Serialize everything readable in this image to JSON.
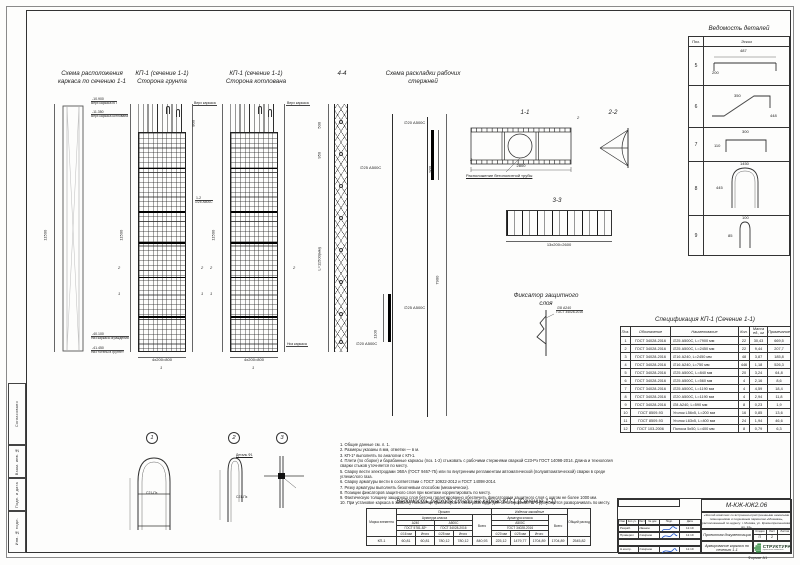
{
  "sheet": {
    "format_label": "Формат А1"
  },
  "side_strip": {
    "agreed": "Согласовано",
    "vzam": "Взам. инв. №",
    "podp": "Подп. и дата",
    "inv": "Инв. № подл."
  },
  "titles": {
    "scheme_location_l1": "Схема расположения",
    "scheme_location_l2": "каркаса по сечению 1-1",
    "kp1_ground_l1": "КП-1 (сечение 1-1)",
    "kp1_ground_l2": "Сторона грунта",
    "kp1_pit_l1": "КП-1 (сечение 1-1)",
    "kp1_pit_l2": "Сторона котлована",
    "section44": "4-4",
    "bars_l1": "Схема раскладки рабочих",
    "bars_l2": "стержней",
    "section11": "1-1",
    "section22": "2-2",
    "section33": "3-3",
    "fixator_l1": "Фиксатор защитного",
    "fixator_l2": "слоя"
  },
  "callouts": {
    "top1_val": "-10.900",
    "top1_text": "Верх каркаса КП",
    "top2_val": "-11.350",
    "top2_text": "Верх каркаса котлована",
    "bot1_val": "-40.100",
    "bot1_text": "Низ каркаса ограждения",
    "bot2_val": "-41.450",
    "bot2_text": "Низ «стены в грунте»",
    "cage_top": "Верх каркаса",
    "cage_bottom": "Низ каркаса",
    "pipe_note": "Расположение бетонолитной трубы"
  },
  "dims": {
    "cage_height": "11500",
    "cage_top": "800",
    "cage_bottom": "4х200=800",
    "lattice_1": "500",
    "lattice_2": "950",
    "lattice_len": "L=11500(мм)",
    "bars_long": "7900",
    "bars_top": "900",
    "bars_bottom": "1100",
    "bar_label_1": "∅25 А500С",
    "bar_label_2": "∅20 А500С",
    "bar_label_3": "∅25 А500С",
    "bar_label_4": "∅20 А500С",
    "cage_bars_mark": "1-2",
    "cage_bars_label": "∅25 А500С",
    "sec11_width": "2800",
    "sec33_width": "13х200=2600",
    "fix_label_1": "∅8 А240",
    "fix_label_2": "ГОСТ 34028-2016",
    "mark1": "1",
    "mark2": "2",
    "mark3": "3",
    "mark4": "4"
  },
  "details_bottom": {
    "d1": "1",
    "d2": "2",
    "d3": "3",
    "weld_mark": "С21-Пз",
    "d2_note": "Деталь Ф1"
  },
  "details_table": {
    "title": "Ведомость деталей",
    "col_poz": "Поз.",
    "col_sketch": "Эскиз",
    "rows": [
      {
        "poz": "5",
        "dim_a": "487",
        "dim_b": "200"
      },
      {
        "poz": "6",
        "dim_a": "350",
        "dim_b": "448"
      },
      {
        "poz": "7",
        "dim_a": "300",
        "dim_b": "110"
      },
      {
        "poz": "8",
        "dim_a": "1450",
        "dim_b": "445"
      },
      {
        "poz": "9",
        "dim_a": "100",
        "dim_b": "85"
      }
    ]
  },
  "spec_table": {
    "title": "Спецификация КП-1 (Сечение 1-1)",
    "columns": [
      "Поз.",
      "Обозначение",
      "Наименование",
      "Кол.",
      "Масса ед., кг",
      "Примечание"
    ],
    "rows": [
      {
        "pos": "1",
        "doc": "ГОСТ 34028-2016",
        "name": "∅25 А500С, L=7900 мм",
        "qty": "22",
        "mass": "30,43",
        "note": "669,5"
      },
      {
        "pos": "2",
        "doc": "ГОСТ 34028-2016",
        "name": "∅25 А500С, L=2450 мм",
        "qty": "22",
        "mass": "9,44",
        "note": "207,7"
      },
      {
        "pos": "3",
        "doc": "ГОСТ 34028-2016",
        "name": "∅16 А240, L=2450 мм",
        "qty": "48",
        "mass": "3,87",
        "note": "185,8"
      },
      {
        "pos": "4",
        "doc": "ГОСТ 34028-2016",
        "name": "∅16 А240, L=750 мм",
        "qty": "446",
        "mass": "1,18",
        "note": "526,3"
      },
      {
        "pos": "5",
        "doc": "ГОСТ 34028-2016",
        "name": "∅25 А500С, L=840 мм",
        "qty": "20",
        "mass": "3,24",
        "note": "64,8"
      },
      {
        "pos": "6",
        "doc": "ГОСТ 34028-2016",
        "name": "∅25 А500С, L=560 мм",
        "qty": "4",
        "mass": "2,16",
        "note": "8,6"
      },
      {
        "pos": "7",
        "doc": "ГОСТ 34028-2016",
        "name": "∅25 А500С, L=1190 мм",
        "qty": "4",
        "mass": "4,59",
        "note": "18,4"
      },
      {
        "pos": "8",
        "doc": "ГОСТ 34028-2016",
        "name": "∅20 А500С, L=1190 мм",
        "qty": "4",
        "mass": "2,94",
        "note": "11,8"
      },
      {
        "pos": "9",
        "doc": "ГОСТ 34028-2016",
        "name": "∅8 А240, L=590 мм",
        "qty": "8",
        "mass": "0,23",
        "note": "1,9"
      },
      {
        "pos": "10",
        "doc": "ГОСТ 8509-93",
        "name": "Уголок L56х5, L=200 мм",
        "qty": "16",
        "mass": "0,85",
        "note": "13,6"
      },
      {
        "pos": "11",
        "doc": "ГОСТ 8509-93",
        "name": "Уголок L63х5, L=400 мм",
        "qty": "24",
        "mass": "1,94",
        "note": "46,6"
      },
      {
        "pos": "12",
        "doc": "ГОСТ 103-2006",
        "name": "Полоса 5х50, L=400 мм",
        "qty": "8",
        "mass": "0,79",
        "note": "6,3"
      }
    ]
  },
  "notes": {
    "items": [
      "1.  Общие данные см. л. 1.",
      "2.  Размеры указаны в мм, отметки — в м.",
      "3.  КП-1* выполнять по аналогии с КП-1.",
      "4.  Плети (по сборке) и барабанные каркасы (поз. 1-2) стыковать с рабочими стержнями сваркой С23-Рэ ГОСТ 14098-2014. Длина и технология сварки стыков уточняется по месту.",
      "5.  Сварку вести электродами Э50А (ГОСТ 9467-75) или по внутренним регламентам автоматической (полуавтоматической) сварки в среде углекислого газа.",
      "6.  Сварку арматуры вести в соответствии с ГОСТ 10922-2012 и ГОСТ 14098-2014.",
      "7.  Резку арматуры выполнять безогневым способом (механически).",
      "8.  Позиции фиксаторов защитного слоя при монтаже корректировать по месту.",
      "9.  Фактическую толщину защитного слоя бетона гарантированно обеспечить фиксаторами защитного слоя с шагом не более 1000 мм.",
      "10. При установке каркаса в захватку положение фиксаторов и схем раскладки для бетонирования Ш-1 допускается разворачивать по месту."
    ]
  },
  "steel_table": {
    "title": "Ведомость расхода стали на каркас КП-1 (Сечение 1-1)",
    "col_mark": "Марка элемента",
    "group1": "Прокат",
    "group2": "Изделия закладные",
    "sub_class1": "Арматура класса",
    "sub_class2": "Арматура класса",
    "class1": "А240",
    "class2": "А500С",
    "class3": "А500С",
    "gost1": "ГОСТ 5781-82*",
    "gost2": "ГОСТ 34028-2016",
    "gost3": "ГОСТ 34028-2016",
    "d1": "∅16 мм",
    "d2": "Итого",
    "d3": "∅25 мм",
    "d4": "Итого",
    "d5": "∅20 мм",
    "d6": "∅25 мм",
    "d7": "Итого",
    "col_total1": "Всего",
    "col_total2": "Всего",
    "col_grand": "Общий расход",
    "row_mark": "КП-1",
    "values": [
      "60,81",
      "60,81",
      "780,12",
      "780,12",
      "840,93",
      "225,12",
      "1479,77",
      "1704,89",
      "1704,89",
      "2545,82"
    ]
  },
  "title_block": {
    "doc_number": "М-КЖ-КЖ2.06",
    "project_desc_l1": "«Жилой комплекс со встроенно-пристроенными нежилыми",
    "project_desc_l2": "помещениями и подземным паркингом «Мозаика»,",
    "project_desc_l3": "расположенный по адресу: г. Москва, ул. Краснопресненская, вл. 14»",
    "hdr_izm": "Изм.",
    "hdr_kol": "Кол.уч.",
    "hdr_list": "Лист",
    "hdr_doc": "№ док.",
    "hdr_podp": "Подп.",
    "hdr_data": "Дата",
    "row1_role": "Разраб.",
    "row1_name": "Иванов",
    "row1_date": "12.19",
    "row2_role": "Проверил",
    "row2_name": "Смирнов",
    "row2_date": "12.19",
    "row3_role": "Н.контр.",
    "row3_name": "Смирнов",
    "row3_date": "12.19",
    "doc_type": "Проектная документация",
    "stage_label": "Стадия",
    "sheet_label": "Лист",
    "sheets_label": "Листов",
    "stage_value": "П",
    "sheet_value": "2",
    "sheets_value": "",
    "drawing_title": "Армирование каркаса по сечению 1-1",
    "company": "СТРУКТУРА",
    "company_tagline": "проектная компания"
  },
  "colors": {
    "accent_signature": "#1d52c8",
    "logo_green": "#2e8b3e",
    "line": "#333333"
  }
}
